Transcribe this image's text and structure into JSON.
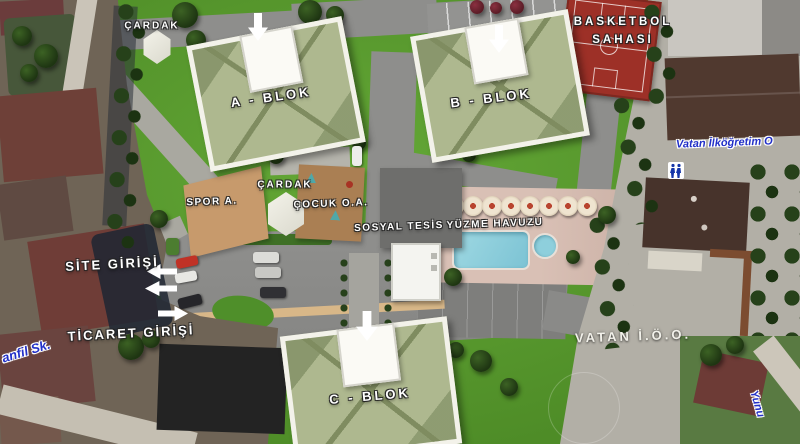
{
  "map": {
    "labels": {
      "cardak_top": "ÇARDAK",
      "a_blok": "A - BLOK",
      "b_blok": "B - BLOK",
      "c_blok": "C - BLOK",
      "basketbol_line1": "BASKETBOL",
      "basketbol_line2": "SAHASI",
      "cardak_center": "ÇARDAK",
      "spor_alani": "SPOR A.",
      "cocuk_oyun_alani": "ÇOCUK O.A.",
      "sosyal_tesis": "SOSYAL TESİS",
      "yuzme_havuzu": "YÜZME HAVUZU",
      "site_girisi": "SİTE GİRİŞİ",
      "ticaret_girisi": "TİCARET GİRİŞİ",
      "vatan_ioo": "VATAN İ.Ö.O.",
      "street_school": "Vatan İlköğretim O",
      "street_sk": "anfil Sk.",
      "street_yunu": "Yunu"
    },
    "colors": {
      "grass": "#5a9c2e",
      "road": "#8e8e8c",
      "basketball_court_red": "#9d3027",
      "pool_blue": "#8ecfdc",
      "pool_deck": "#d9c0b5",
      "roof_green": "#aeb88f",
      "street_label_blue": "#2230c8"
    }
  }
}
